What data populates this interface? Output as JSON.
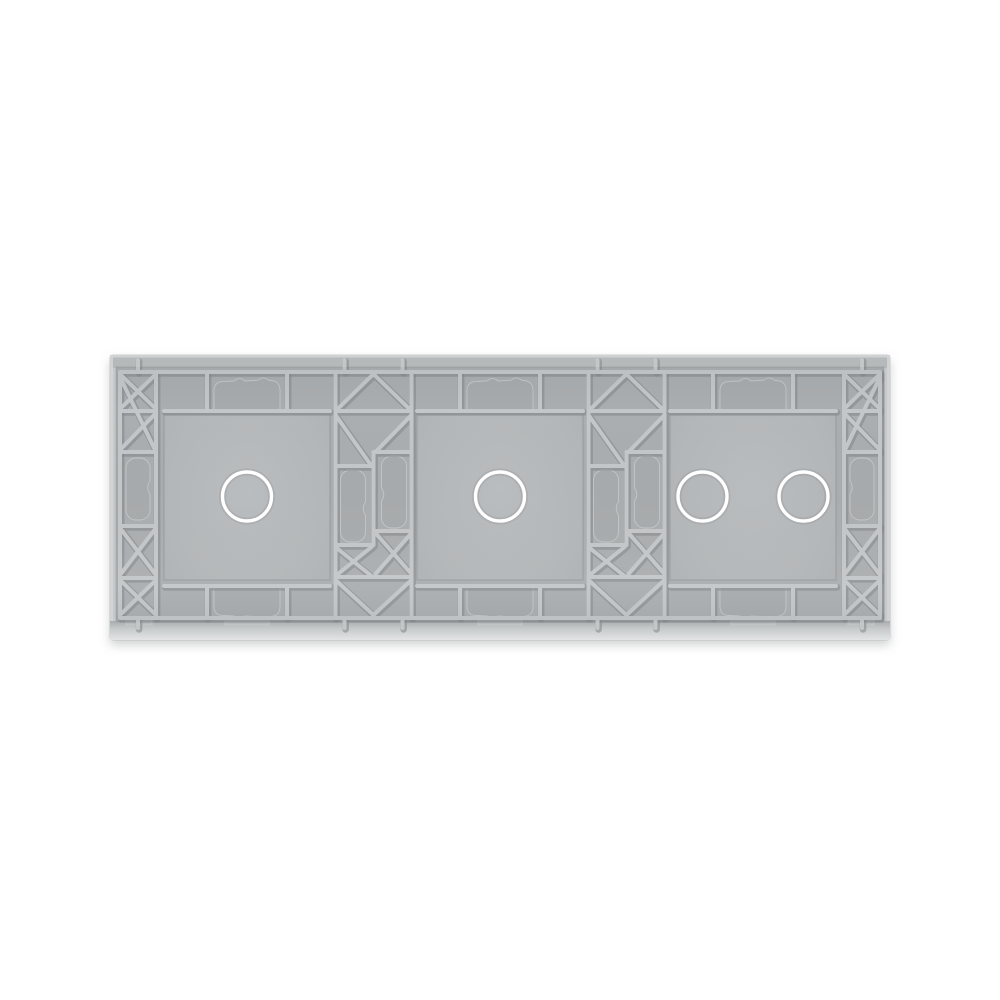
{
  "image": {
    "kind": "product-photo",
    "subject": "3-gang glass touch switch panel, rear view",
    "background": "#ffffff"
  },
  "panel": {
    "gang_count": 3,
    "sections": [
      {
        "id": "gang-1",
        "touch_points": 1
      },
      {
        "id": "gang-2",
        "touch_points": 1
      },
      {
        "id": "gang-3",
        "touch_points": 2
      }
    ],
    "colors": {
      "background": "#ffffff",
      "glass_edge": "#c6c9ca",
      "glass_edge_top": "#b6b9ba",
      "frame_base": "#abaeb0",
      "recess_face": "#b4b7b9",
      "rib_face": "#c4c7c9",
      "rib_shadow": "#83878a",
      "relief_fill": "#a8abad",
      "touch_ring": "#ffffff"
    }
  }
}
